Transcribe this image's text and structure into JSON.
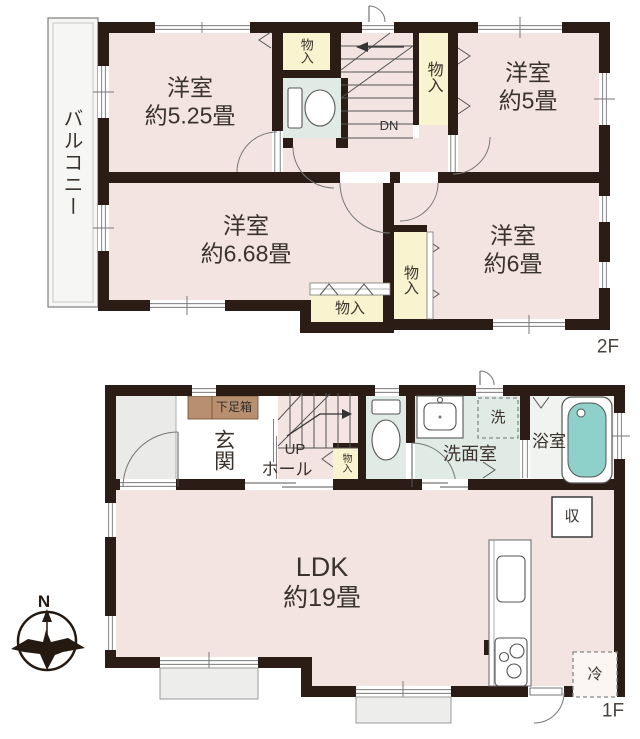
{
  "colors": {
    "wall": "#2b1d16",
    "room_pink": "#f3e4e1",
    "closet_yellow": "#f9f3cf",
    "wet_green": "#e1ebe6",
    "bathtub_teal": "#8ed0ca",
    "shoe_box_tan": "#b9906f",
    "porch_gray": "#eaeae8",
    "balcony_white": "#f6f6f4",
    "step_gray": "#ededeb"
  },
  "floor2": {
    "label": "2F",
    "balcony": "バルコニー",
    "room_tl": {
      "name": "洋室",
      "size": "約5.25畳"
    },
    "room_tr": {
      "name": "洋室",
      "size": "約5畳"
    },
    "room_bl": {
      "name": "洋室",
      "size": "約6.68畳"
    },
    "room_br": {
      "name": "洋室",
      "size": "約6畳"
    },
    "closet_top": "物入",
    "closet_right": "物入",
    "closet_mid": "物入",
    "closet_bottom": "物入",
    "stairs_down": "DN"
  },
  "floor1": {
    "label": "1F",
    "shoe_box": "下足箱",
    "entrance": "玄関",
    "stairs_up": "UP",
    "hall": "ホール",
    "closet": "物入",
    "washer": "洗",
    "washroom": "洗面室",
    "bathroom": "浴室",
    "ldk": {
      "name": "LDK",
      "size": "約19畳"
    },
    "storage": "収",
    "refrigerator": "冷",
    "compass_north": "N"
  }
}
